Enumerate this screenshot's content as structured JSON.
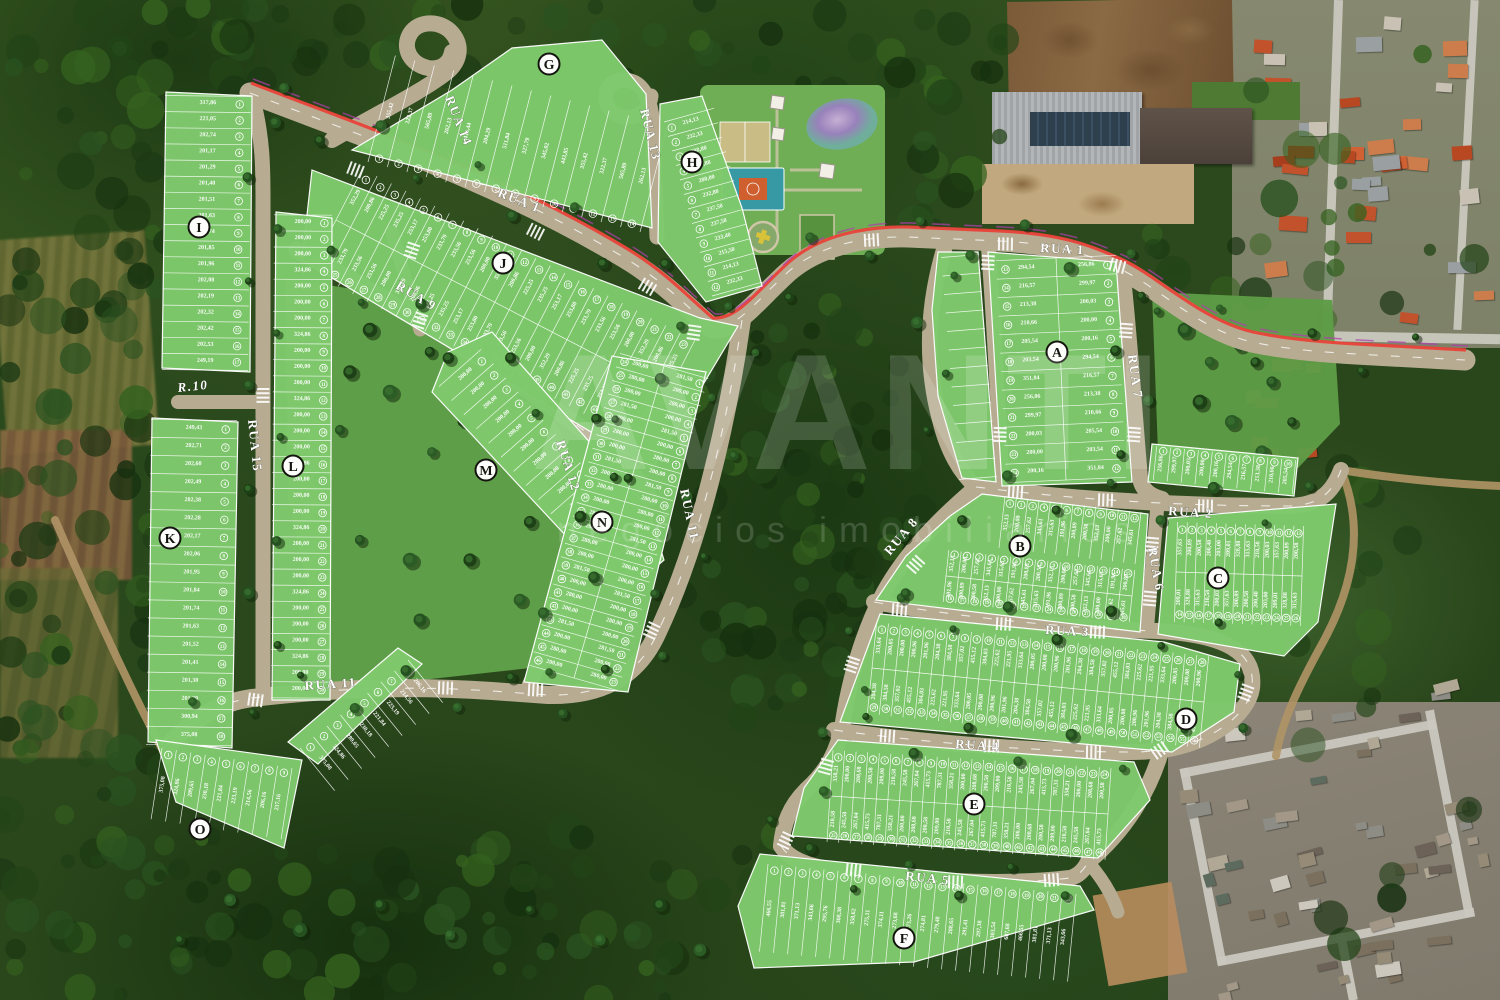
{
  "watermark": {
    "title": "AVANTI",
    "subtitle": "negócios imobiliários"
  },
  "streets": {
    "rua1": "RUA 1",
    "rua2": "RUA 2",
    "rua3": "RUA 3",
    "rua4": "RUA 4",
    "rua5": "RUA 5",
    "rua6": "RUA 6",
    "rua7": "RUA 7",
    "rua8": "RUA 8",
    "rua9": "RUA 9",
    "r10": "R.10",
    "rua11": "RUA 11",
    "rua12": "RUA 12",
    "rua13": "RUA 13",
    "rua14": "RUA 14",
    "rua15": "RUA 15"
  },
  "blocks": [
    {
      "letter": "A",
      "lots": "1–24",
      "areas": [
        "256,86",
        "299,97",
        "200,03",
        "200,00",
        "200,16",
        "294,54",
        "216,57",
        "213,38",
        "210,66",
        "205,54",
        "203,54",
        "351,84"
      ]
    },
    {
      "letter": "B",
      "lots": "1–27",
      "areas": [
        "352,13",
        "200,00",
        "257,62",
        "345,61",
        "315,63",
        "191,96",
        "200,89",
        "200,58"
      ]
    },
    {
      "letter": "C",
      "lots": "1–26",
      "areas": [
        "357,63",
        "200,89",
        "200,58",
        "200,40",
        "203,00",
        "209,01",
        "328,88",
        "315,63",
        "210,58",
        "200,03"
      ]
    },
    {
      "letter": "D",
      "lots": "1–45",
      "areas": [
        "333,64",
        "200,05",
        "200,08",
        "200,96",
        "201,96",
        "204,38",
        "384,58",
        "357,02",
        "455,12",
        "384,03",
        "225,62",
        "221,95"
      ]
    },
    {
      "letter": "E",
      "lots": "1–38",
      "areas": [
        "358,21",
        "200,00",
        "208,68",
        "200,58",
        "209,00",
        "210,58",
        "245,58",
        "267,04",
        "415,73",
        "787,31"
      ]
    },
    {
      "letter": "F",
      "lots": "1–19",
      "areas": [
        "466,55",
        "381,81",
        "371,13",
        "343,66",
        "295,76",
        "308,38",
        "358,62",
        "275,11",
        "374,11",
        "273,68",
        "273,26",
        "274,81",
        "279,48",
        "288,65",
        "291,41",
        "297,38",
        "303,54",
        "607,68"
      ]
    },
    {
      "letter": "G",
      "lots": "1–15",
      "areas": [
        "355,42",
        "322,37",
        "565,89",
        "262,13",
        "418,44",
        "204,29",
        "511,84",
        "327,79",
        "345,02",
        "443,85"
      ]
    },
    {
      "letter": "H",
      "lots": "1–13",
      "areas": [
        "214,13",
        "232,33",
        "288,80",
        "200,88",
        "200,00",
        "232,80",
        "237,50",
        "237,58",
        "233,40",
        "215,50"
      ]
    },
    {
      "letter": "I",
      "lots": "1–17",
      "areas": [
        "317,86",
        "221,05",
        "202,74",
        "201,17",
        "201,29",
        "201,40",
        "201,51",
        "201,63",
        "201,74",
        "201,85",
        "201,96",
        "202,08",
        "202,19",
        "202,32",
        "202,42",
        "202,53",
        "249,19"
      ]
    },
    {
      "letter": "J",
      "lots": "1–45",
      "areas": [
        "352,29",
        "200,86",
        "225,25",
        "235,25",
        "253,17",
        "253,80",
        "233,79",
        "233,56",
        "253,56",
        "200,00"
      ]
    },
    {
      "letter": "K",
      "lots": "1–18",
      "areas": [
        "249,43",
        "202,71",
        "202,60",
        "202,49",
        "202,38",
        "202,28",
        "202,17",
        "202,06",
        "201,95",
        "201,84",
        "201,74",
        "201,63",
        "201,52",
        "201,41",
        "201,30",
        "201,20",
        "300,94",
        "375,08"
      ]
    },
    {
      "letter": "L",
      "lots": "1–19",
      "areas": [
        "200,00",
        "200,00",
        "200,00",
        "324,86"
      ]
    },
    {
      "letter": "M",
      "lots": "1–18",
      "areas": [
        "200,00"
      ]
    },
    {
      "letter": "N",
      "lots": "1–24",
      "areas": [
        "281,50",
        "200,00",
        "280,00",
        "200,00"
      ]
    },
    {
      "letter": "O",
      "lots": "1–12",
      "areas": [
        "375,08",
        "324,86",
        "289,65",
        "230,18",
        "221,84",
        "223,19",
        "214,56",
        "206,16",
        "237,16",
        "244,32",
        "201,76",
        "215,56"
      ]
    }
  ],
  "colors": {
    "lot_green": "#7fca6d",
    "road_tan": "#b7ac92",
    "route_red": "#e8423a",
    "boundary_magenta": "#b13fae",
    "forest": "#2e4e22",
    "pond_purple": "#b48fc9",
    "court_blue": "#3799a4",
    "court_key_orange": "#cf5f2e"
  }
}
